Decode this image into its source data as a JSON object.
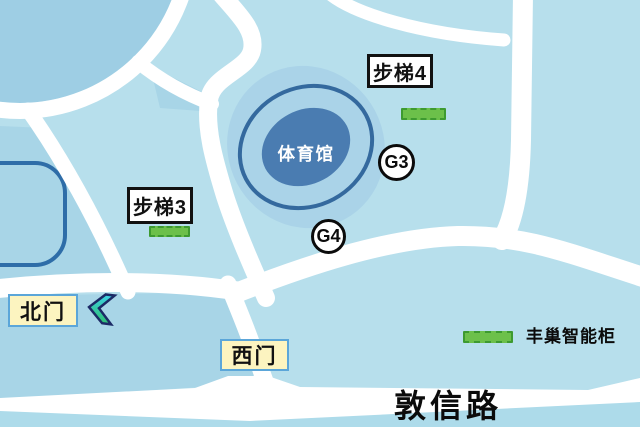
{
  "map": {
    "stadium": {
      "label": "体育馆"
    },
    "road": {
      "label": "敦信路"
    },
    "gates": {
      "north": {
        "label": "北门"
      },
      "west": {
        "label": "西门"
      }
    },
    "stairs": {
      "s3": {
        "label": "步梯3"
      },
      "s4": {
        "label": "步梯4"
      }
    },
    "markers": {
      "g3": {
        "label": "G3"
      },
      "g4": {
        "label": "G4"
      }
    },
    "legend": {
      "locker_label": "丰巢智能柜"
    },
    "icons": {
      "north_gate_direction": "chevron-left-icon"
    },
    "colors": {
      "background": "#b7dfec",
      "block_shade": "#a8d5e7",
      "plaza_circle": "#9ecee4",
      "road_white": "#ffffff",
      "stadium_outer": "#aad3e8",
      "stadium_ring": "#34699e",
      "stadium_inner": "#4a7cb1",
      "pond_border": "#2e6da8",
      "gate_box_fill": "#fcf4c0",
      "gate_box_border": "#5ba6d9",
      "stair_box_border": "#111111",
      "marker_green": "#6cc04a",
      "marker_green_border": "#3d9a30",
      "chevron_cyan": "#3fd2e6",
      "chevron_green": "#2fbf72",
      "chevron_outline": "#1c2a66",
      "bottom_strip": "#addbea"
    }
  }
}
